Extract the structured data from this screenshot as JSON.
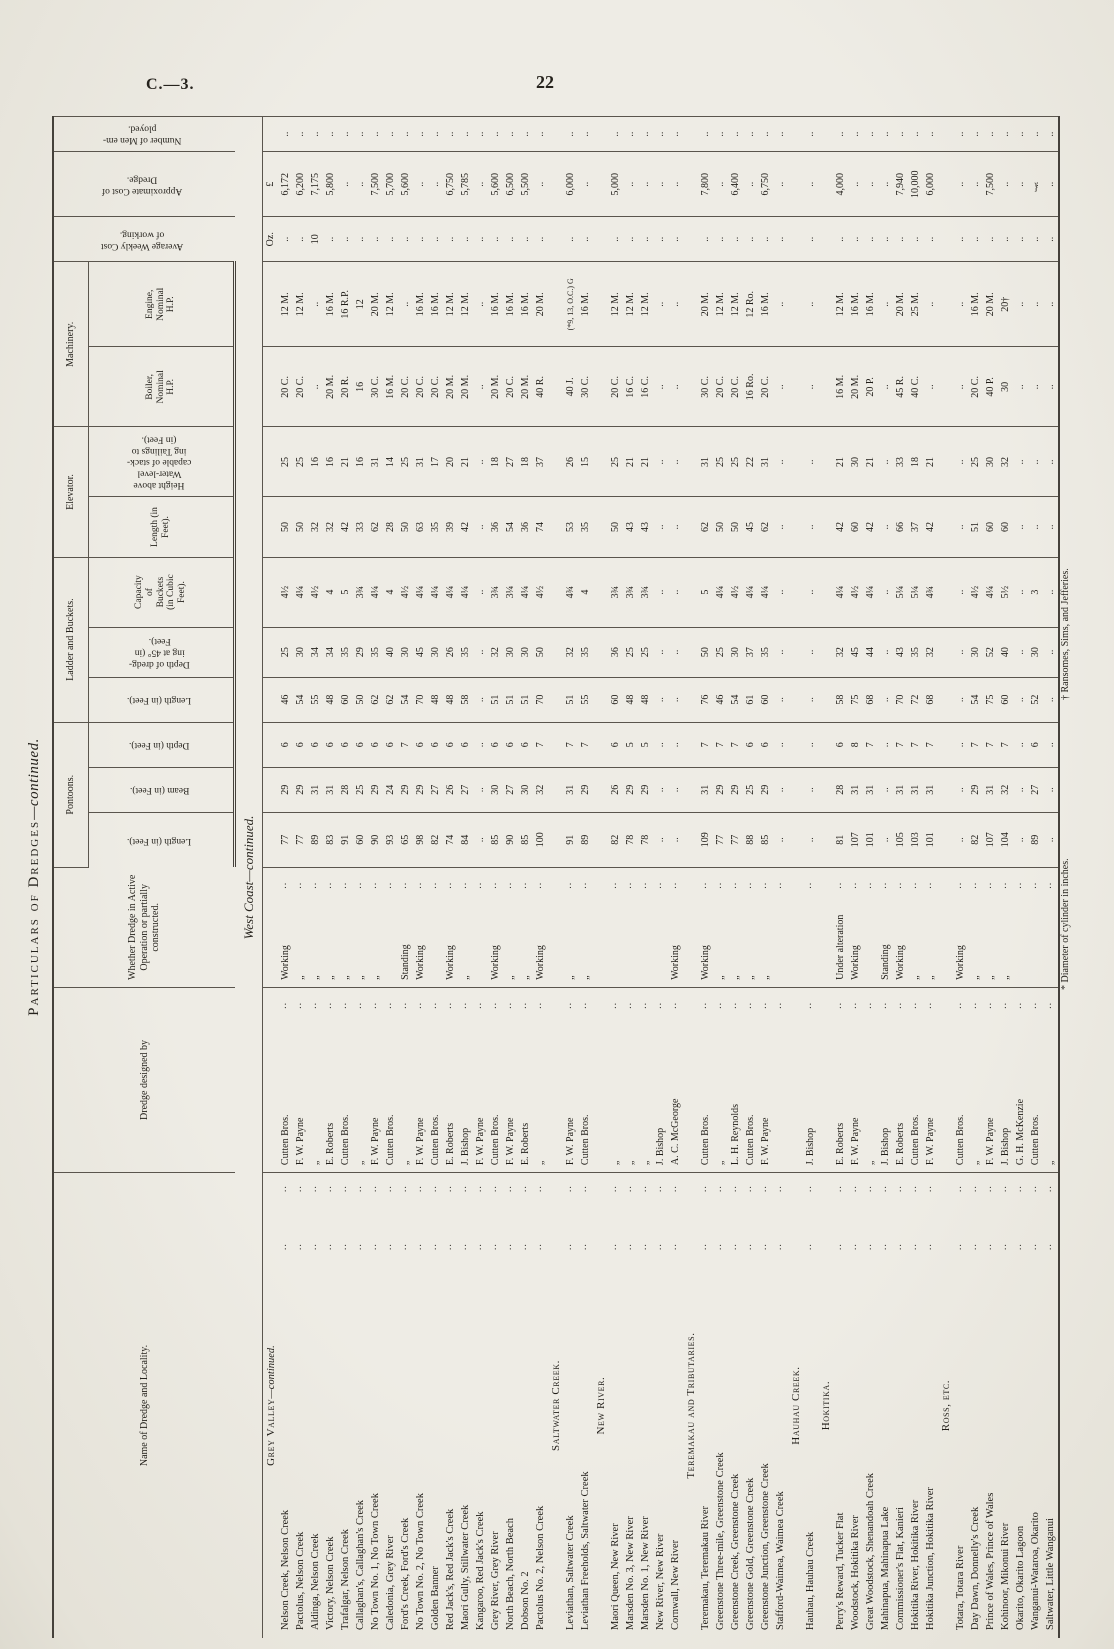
{
  "page": {
    "doc_ref": "C.—3.",
    "page_number": "22"
  },
  "title": {
    "main": "Particulars of Dredges",
    "suffix": "—continued."
  },
  "subtitle": "West Coast—continued.",
  "headers": {
    "name": "Name of Dredge and Locality.",
    "designer": "Dredge designed by",
    "status": "Whether Dredge in Active\nOperation or partially\nconstructed.",
    "groups": {
      "pontoons": "Pontoons.",
      "ladder": "Ladder and Buckets.",
      "elevator": "Elevator.",
      "machinery": "Machinery."
    },
    "sub": {
      "p_len": "Length (in Feet).",
      "p_beam": "Beam (in Feet).",
      "p_depth": "Depth (in Feet).",
      "l_len": "Length (in Feet).",
      "l_d45": "Depth of dredg-\ning at 45° (in\nFeet).",
      "cap": "Capacity\nof\nBuckets\n(in Cubic\nFeet).",
      "e_len": "Length (in\nFeet).",
      "tail": "Height above\nWater-level\ncapable of stack-\ning Tailings to\n(in Feet).",
      "boiler": "Boiler,\nNominal\nH.P.",
      "engine": "Engine,\nNominal\nH.P."
    },
    "weekly": "Average Weekly Cost\nof working.",
    "cost": "Approximate Cost of\nDredge.",
    "men": "Number of Men em-\nployed."
  },
  "units": {
    "weekly": "Oz.",
    "cost": "£"
  },
  "ink_artifact": "}",
  "footnotes": {
    "left": "* Diameter of cylinder in inches.",
    "right": "† Ransomes, Sims, and Jefferies."
  },
  "sections": [
    {
      "heading_main": "Grey Valley",
      "heading_suffix": "—continued.",
      "show_units": true,
      "rows": [
        [
          "Nelson Creek, Nelson Creek",
          "Cutten Bros.",
          "Working",
          "77",
          "29",
          "6",
          "46",
          "25",
          "4½",
          "50",
          "25",
          "20 C.",
          "12 M.",
          "..",
          "6,172",
          ".."
        ],
        [
          "Pactolus, Nelson Creek",
          "F. W. Payne",
          "„",
          "77",
          "29",
          "6",
          "54",
          "30",
          "4¼",
          "50",
          "25",
          "20 C.",
          "12 M.",
          "..",
          "6,200",
          ".."
        ],
        [
          "Aldinga, Nelson Creek",
          "„",
          "„",
          "89",
          "31",
          "6",
          "55",
          "34",
          "4½",
          "32",
          "16",
          "..",
          "..",
          "10",
          "7,175",
          ".."
        ],
        [
          "Victory, Nelson Creek",
          "E. Roberts",
          "„",
          "83",
          "31",
          "6",
          "48",
          "34",
          "4",
          "32",
          "16",
          "20 M.",
          "16 M.",
          "..",
          "5,800",
          ".."
        ],
        [
          "Trafalgar, Nelson Creek",
          "Cutten Bros.",
          "„",
          "91",
          "28",
          "6",
          "60",
          "35",
          "5",
          "42",
          "21",
          "20 R.",
          "16 R.P.",
          "..",
          "..",
          ".."
        ],
        [
          "Callaghan's, Callaghan's Creek",
          "„",
          "„",
          "60",
          "25",
          "6",
          "50",
          "29",
          "3¾",
          "33",
          "16",
          "16",
          "12",
          "..",
          "..",
          ".."
        ],
        [
          "No Town No. 1, No Town Creek",
          "F. W. Payne",
          "„",
          "90",
          "29",
          "6",
          "62",
          "35",
          "4¼",
          "62",
          "31",
          "30 C.",
          "20 M.",
          "..",
          "7,500",
          ".."
        ],
        [
          "Caledonia, Grey River",
          "Cutten Bros.",
          "..",
          "93",
          "24",
          "6",
          "62",
          "40",
          "4",
          "28",
          "14",
          "16 M.",
          "12 M.",
          "..",
          "5,700",
          ".."
        ],
        [
          "Ford's Creek, Ford's Creek",
          "„",
          "Standing",
          "65",
          "29",
          "7",
          "54",
          "30",
          "4½",
          "50",
          "25",
          "20 C.",
          "..",
          "..",
          "5,600",
          ".."
        ],
        [
          "No Town No. 2, No Town Creek",
          "F. W. Payne",
          "Working",
          "98",
          "29",
          "6",
          "70",
          "45",
          "4¼",
          "63",
          "31",
          "20 C.",
          "16 M.",
          "..",
          "..",
          ".."
        ],
        [
          "Golden Banner",
          "Cutten Bros.",
          "..",
          "82",
          "27",
          "6",
          "48",
          "30",
          "4¼",
          "35",
          "17",
          "20 C.",
          "16 M.",
          "..",
          "..",
          ".."
        ],
        [
          "Red Jack's, Red Jack's Creek",
          "E. Roberts",
          "Working",
          "74",
          "26",
          "6",
          "48",
          "26",
          "4¼",
          "39",
          "20",
          "20 M.",
          "12 M.",
          "..",
          "6,750",
          ".."
        ],
        [
          "Maori Gully, Stillwater Creek",
          "J. Bishop",
          "„",
          "84",
          "27",
          "6",
          "58",
          "35",
          "4¼",
          "42",
          "21",
          "20 M.",
          "12 M.",
          "..",
          "5,785",
          ".."
        ],
        [
          "Kangaroo, Red Jack's Creek",
          "F. W. Payne",
          "..",
          "..",
          "..",
          "..",
          "..",
          "..",
          "..",
          "..",
          "..",
          "..",
          "..",
          "..",
          "..",
          ".."
        ],
        [
          "Grey River, Grey River",
          "Cutten Bros.",
          "Working",
          "85",
          "30",
          "6",
          "51",
          "32",
          "3¾",
          "36",
          "18",
          "20 M.",
          "16 M.",
          "..",
          "5,600",
          ".."
        ],
        [
          "North Beach, North Beach",
          "F. W. Payne",
          "„",
          "90",
          "27",
          "6",
          "51",
          "30",
          "3¼",
          "54",
          "27",
          "20 C.",
          "16 M.",
          "..",
          "6,500",
          ".."
        ],
        [
          "Dobson No. 2",
          "E. Roberts",
          "„",
          "85",
          "30",
          "6",
          "51",
          "30",
          "4¼",
          "36",
          "18",
          "20 M.",
          "16 M.",
          "..",
          "5,500",
          ".."
        ],
        [
          "Pactolus No. 2, Nelson Creek",
          "„",
          "Working",
          "100",
          "32",
          "7",
          "70",
          "50",
          "4½",
          "74",
          "37",
          "40 R.",
          "20 M.",
          "..",
          "..",
          ".."
        ]
      ]
    },
    {
      "heading_main": "Saltwater Creek.",
      "heading_suffix": "",
      "show_units": false,
      "rows": [
        [
          "Leviathan, Saltwater Creek",
          "F. W. Payne",
          "„",
          "91",
          "31",
          "7",
          "51",
          "32",
          "4¾",
          "53",
          "26",
          "40 J.",
          "(*9, 13, O.C.) G",
          "..",
          "6,000",
          ".."
        ],
        [
          "Leviathan Freeholds, Saltwater Creek",
          "Cutten Bros.",
          "„",
          "89",
          "29",
          "7",
          "55",
          "35",
          "4",
          "35",
          "15",
          "30 C.",
          "16 M.",
          "..",
          "..",
          ".."
        ]
      ]
    },
    {
      "heading_main": "New River.",
      "heading_suffix": "",
      "show_units": false,
      "rows": [
        [
          "Maori Queen, New River",
          "„",
          "..",
          "82",
          "26",
          "6",
          "60",
          "36",
          "3¾",
          "50",
          "25",
          "20 C.",
          "12 M.",
          "..",
          "5,000",
          ".."
        ],
        [
          "Marsden No. 3, New River",
          "„",
          "..",
          "78",
          "29",
          "5",
          "48",
          "25",
          "3¾",
          "43",
          "21",
          "16 C.",
          "12 M.",
          "..",
          "..",
          ".."
        ],
        [
          "Marsden No. 1, New River",
          "„",
          "..",
          "78",
          "29",
          "5",
          "48",
          "25",
          "3¾",
          "43",
          "21",
          "16 C.",
          "12 M.",
          "..",
          "..",
          ".."
        ],
        [
          "New River, New River",
          "J. Bishop",
          "..",
          "..",
          "..",
          "..",
          "..",
          "..",
          "..",
          "..",
          "..",
          "..",
          "..",
          "..",
          "..",
          ".."
        ],
        [
          "Cornwall, New River",
          "A. C. McGeorge",
          "Working",
          "..",
          "..",
          "..",
          "..",
          "..",
          "..",
          "..",
          "..",
          "..",
          "..",
          "..",
          "..",
          ".."
        ]
      ]
    },
    {
      "heading_main": "Teremakau and Tributaries.",
      "heading_suffix": "",
      "show_units": false,
      "rows": [
        [
          "Teremakau, Teremakau River",
          "Cutten Bros.",
          "Working",
          "109",
          "31",
          "7",
          "76",
          "50",
          "5",
          "62",
          "31",
          "30 C.",
          "20 M.",
          "..",
          "7,800",
          ".."
        ],
        [
          "Greenstone Three-mile, Greenstone Creek",
          "„",
          "„",
          "77",
          "29",
          "7",
          "46",
          "25",
          "4¼",
          "50",
          "25",
          "20 C.",
          "12 M.",
          "..",
          "..",
          ".."
        ],
        [
          "Greenstone Creek, Greenstone Creek",
          "L. H. Reynolds",
          "„",
          "77",
          "29",
          "7",
          "54",
          "30",
          "4½",
          "50",
          "25",
          "20 C.",
          "12 M.",
          "..",
          "6,400",
          ".."
        ],
        [
          "Greenstone Gold, Greenstone Creek",
          "Cutten Bros.",
          "„",
          "88",
          "25",
          "6",
          "61",
          "37",
          "4¼",
          "45",
          "22",
          "16 Ro.",
          "12 Ro.",
          "..",
          "..",
          ".."
        ],
        [
          "Greenstone Junction, Greenstone Creek",
          "F. W. Payne",
          "„",
          "85",
          "29",
          "6",
          "60",
          "35",
          "4¼",
          "62",
          "31",
          "20 C.",
          "16 M.",
          "..",
          "6,750",
          ".."
        ],
        [
          "Stafford-Waimea, Waimea Creek",
          "..",
          "..",
          "..",
          "..",
          "..",
          "..",
          "..",
          "..",
          "..",
          "..",
          "..",
          "..",
          "..",
          "..",
          ".."
        ]
      ]
    },
    {
      "heading_main": "Hauhau Creek.",
      "heading_suffix": "",
      "show_units": false,
      "rows": [
        [
          "Hauhau, Hauhau Creek",
          "J. Bishop",
          "..",
          "..",
          "..",
          "..",
          "..",
          "..",
          "..",
          "..",
          "..",
          "..",
          "..",
          "..",
          "..",
          ".."
        ]
      ]
    },
    {
      "heading_main": "Hokitika.",
      "heading_suffix": "",
      "show_units": false,
      "rows": [
        [
          "Perry's Reward, Tucker Flat",
          "E. Roberts",
          "Under alteration",
          "81",
          "28",
          "6",
          "58",
          "32",
          "4¼",
          "42",
          "21",
          "16 M.",
          "12 M.",
          "..",
          "4,000",
          ".."
        ],
        [
          "Woodstock, Hokitika River",
          "F. W. Payne",
          "Working",
          "107",
          "31",
          "8",
          "75",
          "45",
          "4½",
          "60",
          "30",
          "20 M.",
          "16 M.",
          "..",
          "..",
          ".."
        ],
        [
          "Great Woodstock, Shenandoah Creek",
          "„",
          "..",
          "101",
          "31",
          "7",
          "68",
          "44",
          "4¼",
          "42",
          "21",
          "20 P.",
          "16 M.",
          "..",
          "..",
          ".."
        ],
        [
          "Mahinapua, Mahinapua Lake",
          "J. Bishop",
          "Standing",
          "..",
          "..",
          "..",
          "..",
          "..",
          "..",
          "..",
          "..",
          "..",
          "..",
          "..",
          "..",
          ".."
        ],
        [
          "Commissioner's Flat, Kanieri",
          "E. Roberts",
          "Working",
          "105",
          "31",
          "7",
          "70",
          "43",
          "5¼",
          "66",
          "33",
          "45 R.",
          "20 M.",
          "..",
          "7,940",
          ".."
        ],
        [
          "Hokitika River, Hokitika River",
          "Cutten Bros.",
          "„",
          "103",
          "31",
          "7",
          "72",
          "35",
          "5¼",
          "37",
          "18",
          "40 C.",
          "25 M.",
          "..",
          "10,000",
          ".."
        ],
        [
          "Hokitika Junction, Hokitika River",
          "F. W. Payne",
          "„",
          "101",
          "31",
          "7",
          "68",
          "32",
          "4¾",
          "42",
          "21",
          "..",
          "..",
          "..",
          "6,000",
          ".."
        ]
      ]
    },
    {
      "heading_main": "Ross, etc.",
      "heading_suffix": "",
      "show_units": false,
      "rows": [
        [
          "Totara, Totara River",
          "Cutten Bros.",
          "Working",
          "..",
          "..",
          "..",
          "..",
          "..",
          "..",
          "..",
          "..",
          "..",
          "..",
          "..",
          "..",
          ".."
        ],
        [
          "Day Dawn, Donnelly's Creek",
          "„",
          "„",
          "82",
          "29",
          "7",
          "54",
          "30",
          "4½",
          "51",
          "25",
          "20 C.",
          "16 M.",
          "..",
          "..",
          ".."
        ],
        [
          "Prince of Wales, Prince of Wales",
          "F. W. Payne",
          "„",
          "107",
          "31",
          "7",
          "75",
          "52",
          "4¼",
          "60",
          "30",
          "40 P.",
          "20 M.",
          "..",
          "7,500",
          ".."
        ],
        [
          "Kohinoor, Mikonui River",
          "J. Bishop",
          "„",
          "104",
          "32",
          "7",
          "60",
          "40",
          "5½",
          "60",
          "32",
          "30",
          "20†",
          "..",
          "..",
          ".."
        ],
        [
          "Okarito, Okarito Lagoon",
          "G. H. McKenzie",
          "..",
          "..",
          "..",
          "..",
          "..",
          "..",
          "..",
          "..",
          "..",
          "..",
          "..",
          "..",
          "..",
          ".."
        ],
        [
          "Wanganui-Wataroa, Okarito",
          "Cutten Bros.",
          "..",
          "89",
          "27",
          "6",
          "52",
          "30",
          "3",
          "..",
          "..",
          "..",
          "..",
          "..",
          "..",
          ".."
        ],
        [
          "Saltwater, Little Wanganui",
          "„",
          "..",
          "..",
          "..",
          "..",
          "..",
          "..",
          "..",
          "..",
          "..",
          "..",
          "..",
          "..",
          "..",
          ".."
        ]
      ]
    }
  ]
}
